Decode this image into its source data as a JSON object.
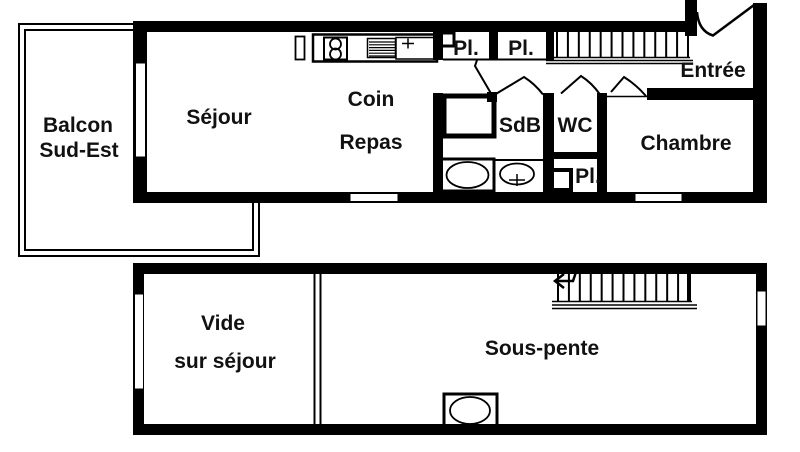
{
  "plan": {
    "kind": "apartment floor plan",
    "colors": {
      "wall": "#000000",
      "floor": "#ffffff",
      "label": "#111111"
    },
    "levels": [
      {
        "name": "main-level",
        "rooms": [
          {
            "id": "balcon",
            "label_lines": [
              "Balcon",
              "Sud-Est"
            ]
          },
          {
            "id": "sejour",
            "label": "Séjour"
          },
          {
            "id": "coin-repas",
            "label_lines": [
              "Coin",
              "Repas"
            ]
          },
          {
            "id": "placard-1",
            "label": "Pl."
          },
          {
            "id": "placard-2",
            "label": "Pl."
          },
          {
            "id": "sdb",
            "label": "SdB"
          },
          {
            "id": "wc",
            "label": "WC"
          },
          {
            "id": "placard-3",
            "label": "Pl."
          },
          {
            "id": "entree",
            "label": "Entrée"
          },
          {
            "id": "chambre",
            "label": "Chambre"
          }
        ],
        "fixtures": [
          "kitchen-hob-icon",
          "kitchen-drainer-icon",
          "kitchen-sink-icon",
          "shower-icon",
          "bathtub-icon",
          "washbasin-icon",
          "water-heater-icon",
          "staircase-icon",
          "entrance-door-icon",
          "door-swing-icon",
          "window-icon"
        ]
      },
      {
        "name": "upper-level",
        "rooms": [
          {
            "id": "vide-sur-sejour",
            "label_lines": [
              "Vide",
              "sur séjour"
            ]
          },
          {
            "id": "sous-pente",
            "label": "Sous-pente"
          }
        ],
        "fixtures": [
          "staircase-icon",
          "direction-arrow-icon",
          "roof-window-icon",
          "window-icon"
        ]
      }
    ]
  }
}
